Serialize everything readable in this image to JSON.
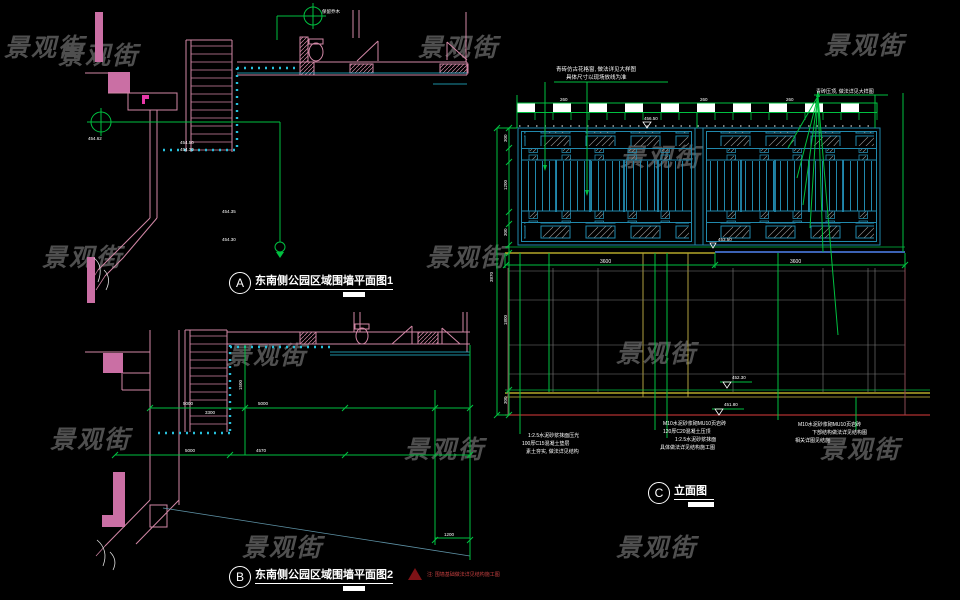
{
  "watermark": {
    "text": "景观街",
    "color": "#4f4f4f"
  },
  "titles": {
    "plan1": {
      "bubble": "A",
      "text": "东南侧公园区域围墙平面图1"
    },
    "plan2": {
      "bubble": "B",
      "text": "东南侧公园区域围墙平面图2"
    },
    "elevation": {
      "bubble": "C",
      "text": "立面图"
    }
  },
  "warning_note": "注: 围墙基础做法详见结构施工图",
  "plan1_labels": {
    "tree": "保留乔木",
    "datum": "454.62",
    "lv1": "454.50",
    "lv4": "454.30",
    "lv2": "454.35",
    "lv3": "454.30"
  },
  "plan2_labels": {
    "d1": "5000",
    "d2": "5000",
    "d3": "5000",
    "d4": "4570",
    "d5": "1500",
    "d6": "3300",
    "d7": "1200"
  },
  "elevation_labels": {
    "note_top1": "青砖仿古花格窗, 做法详见大样图",
    "note_top2": "具体尺寸以现场放线为准",
    "note_right": "青砖压顶, 做法详见大样图",
    "band_d1": "260",
    "band_d2": "260",
    "band_d3": "260",
    "dim_left_total": "3870",
    "dim_left": [
      "300",
      "1200",
      "300",
      "1800",
      "300"
    ],
    "dim_h1": "3600",
    "dim_h2": "3600",
    "lv_top": "456.50",
    "lv_base": "453.50",
    "lv_mid": "452.30",
    "lv_low": "451.80",
    "notes_g1": [
      "1:2.5水泥砂浆抹面压光",
      "100厚C15混凝土垫层",
      "素土夯实, 做法详见结构"
    ],
    "notes_g2": [
      "M10水泥砂浆砌MU10页岩砖",
      "120厚C20混凝土压顶",
      "1:2.5水泥砂浆抹面",
      "具体做法详见结构施工图"
    ],
    "notes_g3": [
      "M10水泥砂浆砌MU10页岩砖",
      "下部结构做法详见结构图",
      "相关详图见结施"
    ]
  }
}
